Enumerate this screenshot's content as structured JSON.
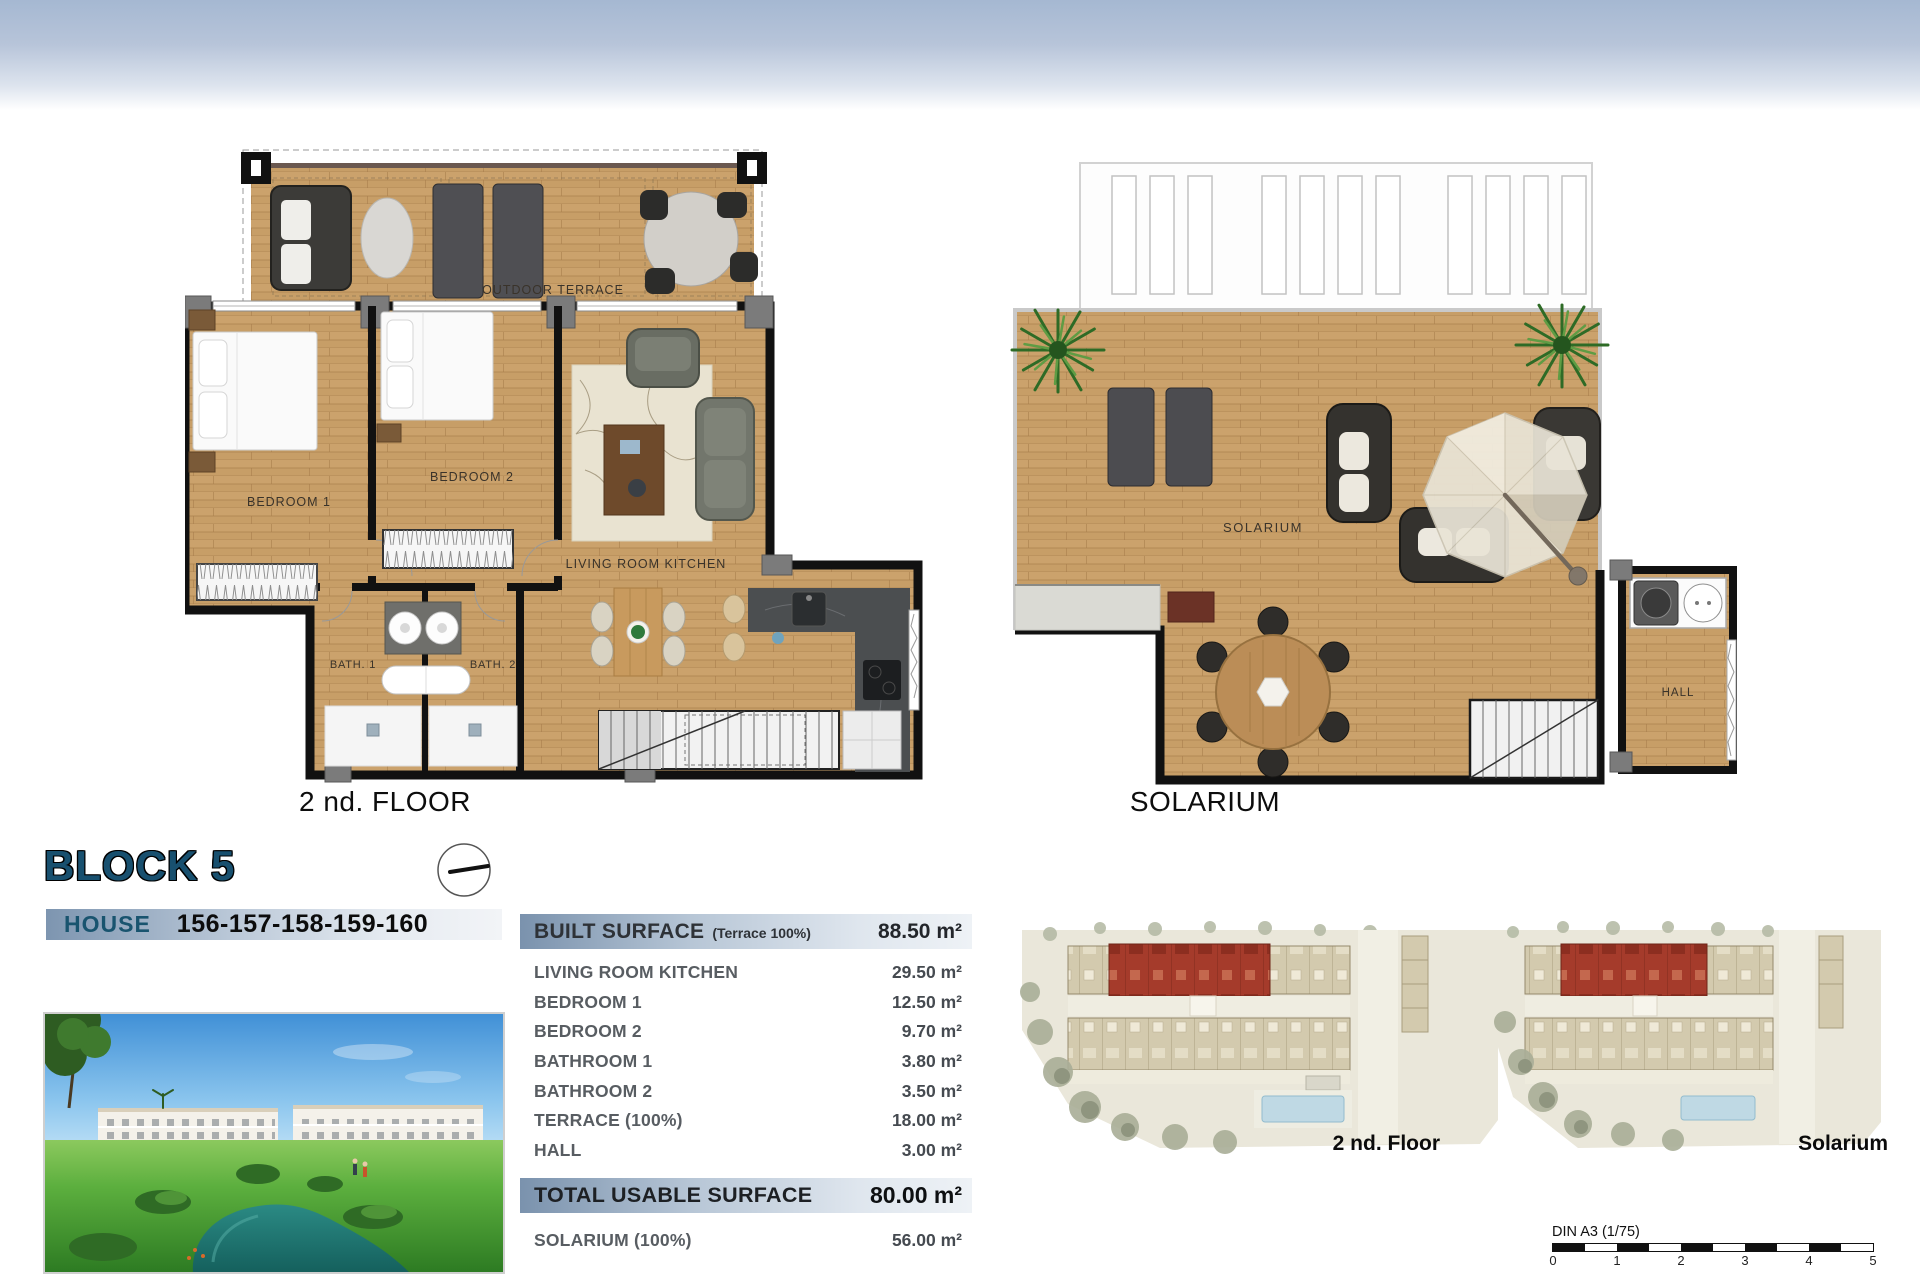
{
  "header": {
    "block_title": "BLOCK 5",
    "house_label": "HOUSE",
    "house_numbers": "156-157-158-159-160"
  },
  "plans": {
    "second_floor": {
      "title": "2 nd. FLOOR",
      "labels": {
        "outdoor_terrace": "OUTDOOR TERRACE",
        "bedroom1": "BEDROOM 1",
        "bedroom2": "BEDROOM 2",
        "living": "LIVING ROOM KITCHEN",
        "bath1": "BATH. 1",
        "bath2": "BATH. 2"
      }
    },
    "solarium": {
      "title": "SOLARIUM",
      "labels": {
        "solarium": "SOLARIUM",
        "hall": "HALL"
      }
    }
  },
  "surface_table": {
    "built": {
      "label": "BUILT SURFACE",
      "note": "(Terrace 100%)",
      "value": "88.50 m²"
    },
    "rows": [
      {
        "label": "LIVING ROOM KITCHEN",
        "value": "29.50 m²"
      },
      {
        "label": "BEDROOM 1",
        "value": "12.50 m²"
      },
      {
        "label": "BEDROOM 2",
        "value": "9.70 m²"
      },
      {
        "label": "BATHROOM 1",
        "value": "3.80 m²"
      },
      {
        "label": "BATHROOM 2",
        "value": "3.50 m²"
      },
      {
        "label": "TERRACE (100%)",
        "value": "18.00 m²"
      },
      {
        "label": "HALL",
        "value": "3.00 m²"
      }
    ],
    "total": {
      "label": "TOTAL USABLE SURFACE",
      "value": "80.00 m²"
    },
    "solarium_row": {
      "label": "SOLARIUM (100%)",
      "value": "56.00 m²"
    }
  },
  "site_plans": {
    "second_floor_label": "2 nd. Floor",
    "solarium_label": "Solarium"
  },
  "scale_bar": {
    "label": "DIN A3 (1/75)",
    "ticks": [
      "0",
      "1",
      "2",
      "3",
      "4",
      "5"
    ]
  },
  "colors": {
    "accent_blue": "#18506f",
    "wall": "#111111",
    "wood": "#c79e67",
    "highlight_red": "#a53b2b"
  }
}
